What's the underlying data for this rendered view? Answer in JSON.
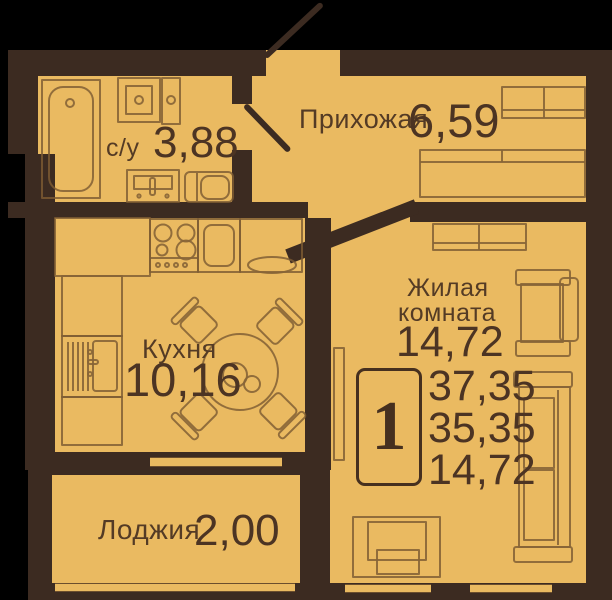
{
  "plan": {
    "type": "apartment-floor-plan",
    "language": "ru",
    "rooms": {
      "bathroom": {
        "label": "с/у",
        "area": "3,88"
      },
      "hallway": {
        "label": "Прихожая",
        "area": "6,59"
      },
      "kitchen": {
        "label": "Кухня",
        "area": "10,16"
      },
      "living": {
        "label_line1": "Жилая",
        "label_line2": "комната",
        "area": "14,72"
      },
      "loggia": {
        "label": "Лоджия",
        "area": "2,00"
      }
    },
    "summary": {
      "unit_number": "1",
      "total_area": "37,35",
      "usable_area": "35,35",
      "living_area": "14,72"
    },
    "palette": {
      "background": "#000000",
      "wall": "#3c2b21",
      "floor": "#eaba61",
      "furniture_line": "#7d5c33",
      "text": "#543b25"
    },
    "furniture": [
      "bathtub",
      "washbasin",
      "water-heater",
      "vanity-unit",
      "toilet",
      "entrance-door",
      "bathroom-door",
      "hallway-cabinet",
      "wardrobe",
      "living-cabinet",
      "tv",
      "lounge-chair",
      "sofa",
      "armchair",
      "kitchen-corner-counter",
      "stove",
      "fridge",
      "kitchen-counter",
      "kitchen-sink",
      "kitchen-cabinet",
      "dining-table",
      "dining-chairs",
      "windows"
    ]
  }
}
